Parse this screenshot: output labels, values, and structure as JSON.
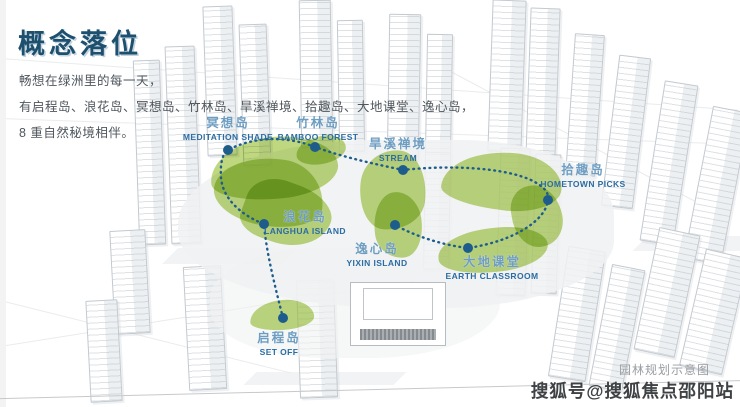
{
  "header": {
    "title": "概念落位",
    "intro_lines": [
      "畅想在绿洲里的每一天，",
      "有启程岛、浪花岛、冥想岛、竹林岛、旱溪禅境、拾趣岛、大地课堂、逸心岛，",
      "8 重自然秘境相伴。"
    ]
  },
  "islands": [
    {
      "cn": "冥想岛",
      "en": "MEDITATION SHADE"
    },
    {
      "cn": "竹林岛",
      "en": "BAMBOO FOREST"
    },
    {
      "cn": "旱溪禅境",
      "en": "STREAM"
    },
    {
      "cn": "拾趣岛",
      "en": "HOMETOWN PICKS"
    },
    {
      "cn": "浪花岛",
      "en": "LANGHUA ISLAND"
    },
    {
      "cn": "逸心岛",
      "en": "YIXIN ISLAND"
    },
    {
      "cn": "大地课堂",
      "en": "EARTH CLASSROOM"
    },
    {
      "cn": "启程岛",
      "en": "SET OFF"
    }
  ],
  "watermark": {
    "caption": "园林规划示意图",
    "account": "搜狐号@搜狐焦点邵阳站"
  },
  "colors": {
    "accent": "#1d4f6e",
    "intro_text": "#4f565c",
    "island_green": "#b4d169",
    "route_blue": "#1e5c8c",
    "label_cn": "#6e9dc2",
    "label_en": "#2b6ca3",
    "watermark_caption": "#989da1",
    "watermark_account": "#3f4245"
  }
}
